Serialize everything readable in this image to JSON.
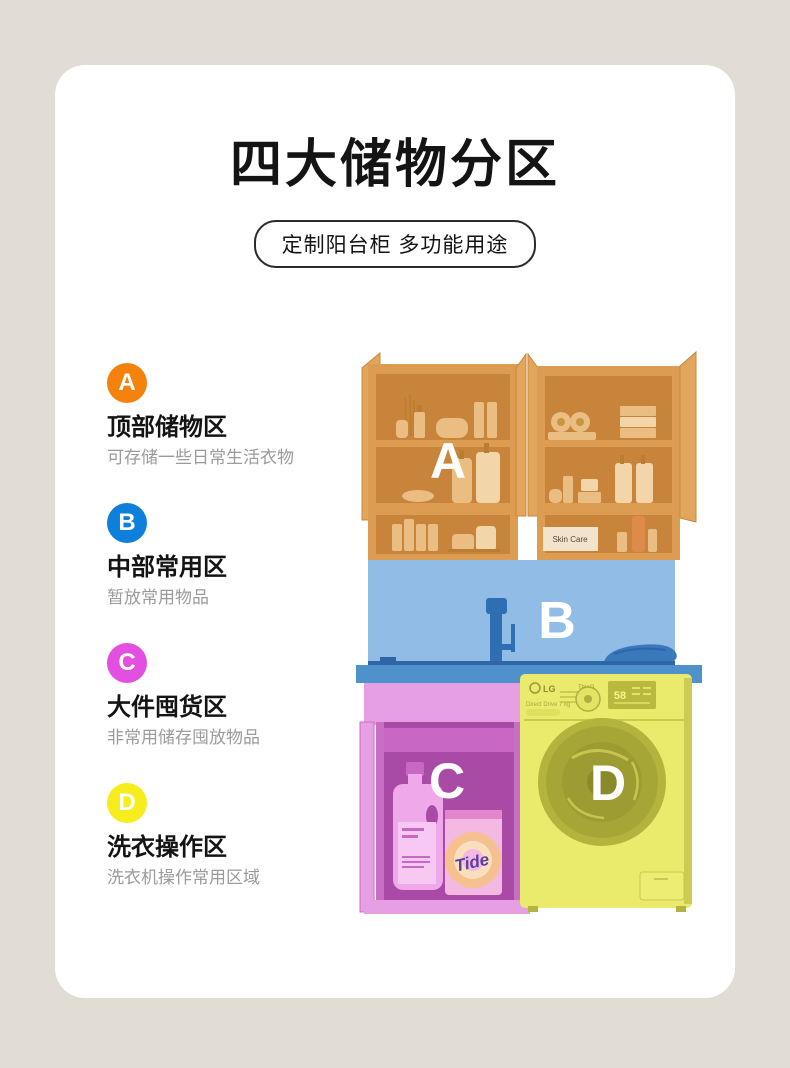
{
  "page": {
    "background_color": "#E2DDD4",
    "card_color": "#FFFFFF"
  },
  "header": {
    "title": "四大储物分区",
    "subtitle": "定制阳台柜 多功能用途"
  },
  "zones": [
    {
      "letter": "A",
      "title": "顶部储物区",
      "desc": "可存储一些日常生活衣物",
      "color": "#F5820D"
    },
    {
      "letter": "B",
      "title": "中部常用区",
      "desc": "暂放常用物品",
      "color": "#0E7FDA"
    },
    {
      "letter": "C",
      "title": "大件囤货区",
      "desc": "非常用储存囤放物品",
      "color": "#E34FE0"
    },
    {
      "letter": "D",
      "title": "洗衣操作区",
      "desc": "洗衣机操作常用区域",
      "color": "#F6EC1E"
    }
  ],
  "illustration": {
    "overlays": {
      "a": {
        "letter": "A",
        "tint": "#DC9C51"
      },
      "b": {
        "letter": "B",
        "tint": "#90BCE6"
      },
      "c": {
        "letter": "C",
        "tint": "#A94BA6"
      },
      "d": {
        "letter": "D",
        "tint": "#EAEA6C"
      }
    },
    "labels": {
      "skin_care": "Skin Care",
      "tide": "Tide",
      "lg": "LG",
      "thinq": "ThinQ",
      "drive_text": "Direct Drive 7 kg",
      "display": "58"
    }
  }
}
